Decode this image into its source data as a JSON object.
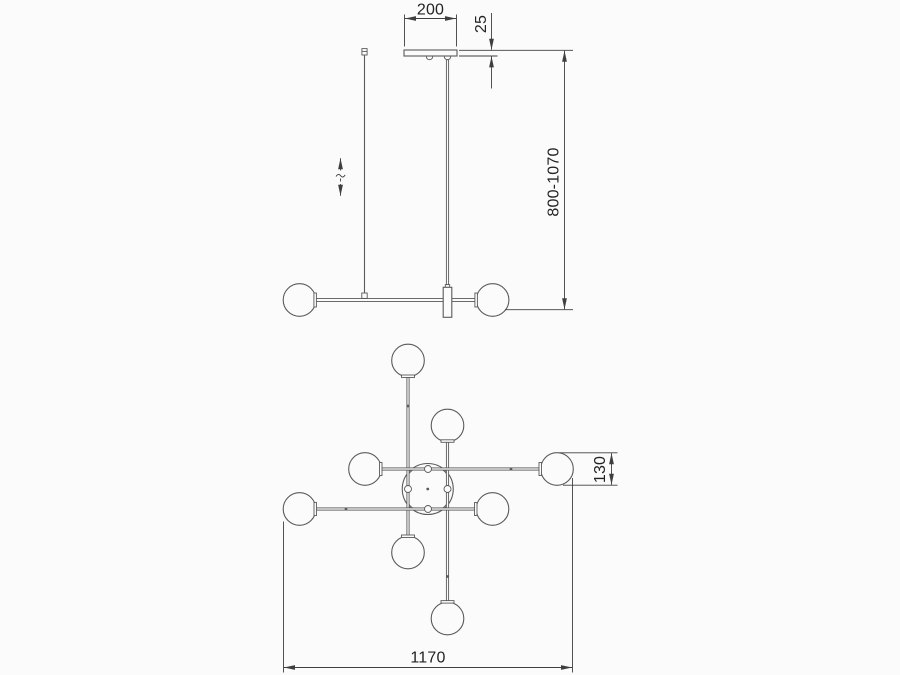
{
  "drawing_type": "luminaire-dimension-drawing",
  "colors": {
    "background": "#fbfbfb",
    "object_line": "#5a5a5a",
    "dimension_line": "#3f3f3f",
    "text": "#232323"
  },
  "front_view": {
    "dim_canopy_width": "200",
    "dim_canopy_thickness": "25",
    "dim_suspension_height": "800-1070",
    "height_adjust_icon": "adjustable-height-symbol"
  },
  "plan_view": {
    "dim_shade_diameter": "130",
    "dim_total_width": "1170"
  }
}
